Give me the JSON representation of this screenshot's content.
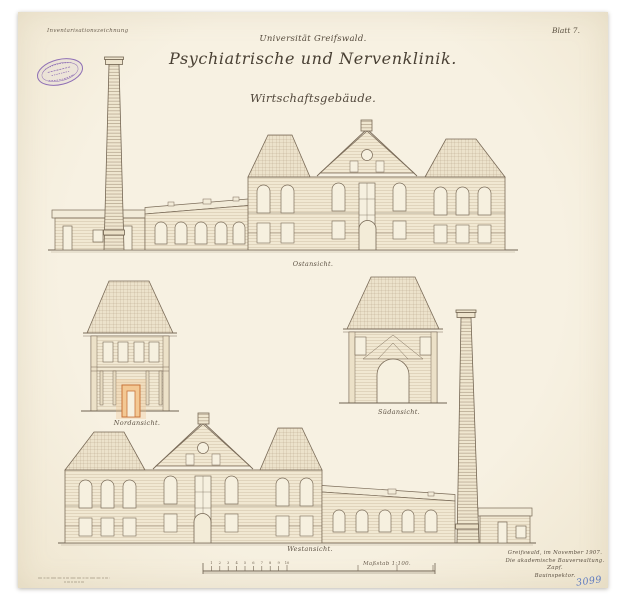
{
  "sheet": {
    "annotation_top_left": "Inventarisationszeichnung",
    "sheet_number": "Blatt 7.",
    "header": {
      "university": "Universität Greifswald.",
      "title": "Psychiatrische und Nervenklinik.",
      "subtitle": "Wirtschaftsgebäude."
    }
  },
  "elevations": {
    "east": {
      "caption": "Ostansicht."
    },
    "north": {
      "caption": "Nordansicht."
    },
    "south": {
      "caption": "Südansicht."
    },
    "west": {
      "caption": "Westansicht."
    }
  },
  "scale_bar": {
    "label": "Maßstab 1:100.",
    "tick_labels": [
      "1",
      "2",
      "3",
      "4",
      "5",
      "6",
      "7",
      "8",
      "9",
      "10"
    ]
  },
  "signature": {
    "place_date": "Greifswald, im November 1907.",
    "office": "Die akademische Bauverwaltung.",
    "name": "Zapf.",
    "title": "Bauinspektor."
  },
  "archive_number": "3099",
  "colors": {
    "paper": "#f5eedd",
    "ink": "#7a6b58",
    "stamp_purple": "#8f6fb5",
    "highlight_orange": "#e8a95c",
    "pencil_blue": "#5f7cc0"
  }
}
